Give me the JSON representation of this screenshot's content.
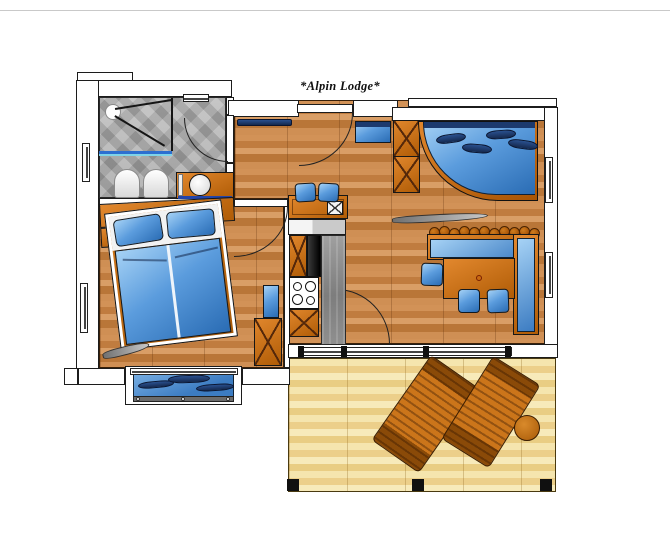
{
  "title": "*Alpin Lodge*",
  "palette": {
    "wood_floor": "#c8854e",
    "terrace_wood": "#f0dca2",
    "bathroom_tile": "#ababab",
    "wall_fill": "#ffffff",
    "outline": "#1c1c1c",
    "furniture_orange": "#c76a10",
    "upholstery_blue": "#3f86c8",
    "cushion_navy": "#1d3a6e",
    "concrete_gray": "#8b8b8b"
  },
  "rooms": {
    "bathroom": "bathroom",
    "bedroom": "bedroom",
    "hallway": "entry hall",
    "kitchen": "kitchenette",
    "living": "living / dining room",
    "balcony": "balcony",
    "terrace": "terrace"
  },
  "furniture": {
    "bathroom": [
      "shower",
      "toilet",
      "bidet",
      "washbasin vanity"
    ],
    "bedroom": [
      "double bed",
      "headboard panel",
      "wardrobe",
      "side cabinet"
    ],
    "kitchen": [
      "console table",
      "two stools",
      "counter",
      "oven",
      "stove with 4 burners",
      "cabinets"
    ],
    "living": [
      "curved sofa",
      "wardrobe",
      "corner bench",
      "dining table",
      "three chairs",
      "entry bench"
    ],
    "terrace": [
      "two sun loungers",
      "round side table"
    ]
  }
}
